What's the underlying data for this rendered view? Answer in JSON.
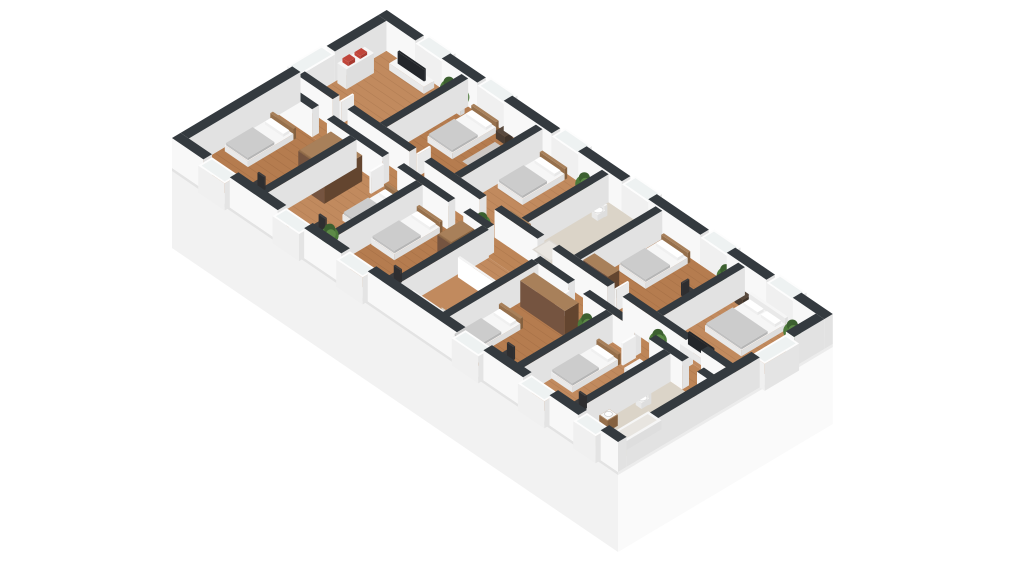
{
  "scene": {
    "description": "isometric-3d-floor-plan",
    "width": 1024,
    "height": 576,
    "background": "#ffffff"
  },
  "projection": {
    "ox": 172,
    "oy": 168,
    "ux": 0.826,
    "uy": 0.563,
    "vx": 0.859,
    "vy": -0.512,
    "planLength": 540,
    "planWidth": 250,
    "wallHeightExt": 30,
    "wallHeightInt": 28,
    "plinthDepth": 80
  },
  "colors": {
    "wallTop": "#343a3f",
    "wallTopDark": "#2b3035",
    "wallFace": "#f8f8f8",
    "wallFaceShade": "#e2e2e2",
    "plinthFront": "#f2f2f2",
    "plinthEnd": "#fafafa",
    "floorWoodA": "#b57c4f",
    "floorWoodB": "#c18a5e",
    "floorCorridor": "#bd8557",
    "floorBath": "#dbd4c8",
    "plankLine": "rgba(60,30,10,0.10)",
    "furnWhiteTop": "#f6f6f6",
    "furnWhiteF1": "#e9e9e9",
    "furnWhiteF2": "#dedede",
    "blanketTop": "#cccccc",
    "blanketF1": "#c0c0c0",
    "blanketF2": "#b5b5b5",
    "pillow": "#ffffff",
    "woodDarkTop": "#8a6747",
    "woodDarkF1": "#755440",
    "woodDarkF2": "#63452f",
    "woodMidTop": "#a8805a",
    "woodMidF1": "#96704c",
    "woodMidF2": "#85613f",
    "nightTop": "#58493d",
    "nightF1": "#4a3d33",
    "nightF2": "#3e332a",
    "chair": "#3c3c3e",
    "chairDark": "#2e2e30",
    "tv": "#23262a",
    "glass": "#eef2f2",
    "windowFrameTop": "#fdfdfd",
    "windowFrameF1": "#f0f0f0",
    "windowFrameF2": "#e4e4e4",
    "rug": "#d0d0d0",
    "plantGreen": "#4d7a3a",
    "plantGreenDark": "#3c6030",
    "plantGreenLight": "#5d8a47",
    "pot": "#ececec",
    "stairSide": "#d6d0c7",
    "rail": "#f4f4f4",
    "shelfAccent": "#c0453a",
    "showerTray": "#dcd8d2",
    "tubInner": "#e8e5e0"
  },
  "rooms": [
    {
      "id": "living-room",
      "x": 10,
      "y": 145,
      "w": 95,
      "h": 95,
      "floor": "floorWoodB",
      "wood": true
    },
    {
      "id": "bedroom-2",
      "x": 105,
      "y": 145,
      "w": 90,
      "h": 95,
      "floor": "floorWoodA",
      "wood": true
    },
    {
      "id": "bedroom-3",
      "x": 195,
      "y": 145,
      "w": 80,
      "h": 95,
      "floor": "floorWoodB",
      "wood": true
    },
    {
      "id": "bathroom-1",
      "x": 275,
      "y": 145,
      "w": 65,
      "h": 95,
      "floor": "floorBath",
      "wood": false
    },
    {
      "id": "bedroom-4",
      "x": 340,
      "y": 145,
      "w": 100,
      "h": 95,
      "floor": "floorWoodA",
      "wood": true
    },
    {
      "id": "bedroom-5",
      "x": 440,
      "y": 145,
      "w": 90,
      "h": 95,
      "floor": "floorWoodB",
      "wood": true
    },
    {
      "id": "bedroom-6",
      "x": 10,
      "y": 10,
      "w": 90,
      "h": 105,
      "floor": "floorWoodA",
      "wood": true
    },
    {
      "id": "bedroom-7",
      "x": 100,
      "y": 10,
      "w": 80,
      "h": 105,
      "floor": "floorWoodB",
      "wood": true
    },
    {
      "id": "bedroom-8",
      "x": 180,
      "y": 10,
      "w": 80,
      "h": 105,
      "floor": "floorWoodA",
      "wood": true
    },
    {
      "id": "stairwell",
      "x": 260,
      "y": 10,
      "w": 60,
      "h": 105,
      "floor": "floorWoodB",
      "wood": true
    },
    {
      "id": "bedroom-9",
      "x": 320,
      "y": 10,
      "w": 90,
      "h": 105,
      "floor": "floorWoodA",
      "wood": true
    },
    {
      "id": "bedroom-10",
      "x": 410,
      "y": 10,
      "w": 70,
      "h": 105,
      "floor": "floorWoodB",
      "wood": true
    },
    {
      "id": "bathroom-2",
      "x": 480,
      "y": 10,
      "w": 50,
      "h": 105,
      "floor": "floorBath",
      "wood": false
    },
    {
      "id": "corridor",
      "x": 10,
      "y": 115,
      "w": 520,
      "h": 30,
      "floor": "floorCorridor",
      "wood": true
    }
  ],
  "walls": {
    "exterior": [
      {
        "x": 0,
        "y": 240,
        "w": 45,
        "h": 10
      },
      {
        "x": 77,
        "y": 240,
        "w": 43,
        "h": 10
      },
      {
        "x": 152,
        "y": 240,
        "w": 58,
        "h": 10
      },
      {
        "x": 242,
        "y": 240,
        "w": 53,
        "h": 10
      },
      {
        "x": 327,
        "y": 240,
        "w": 63,
        "h": 10
      },
      {
        "x": 422,
        "y": 240,
        "w": 48,
        "h": 10
      },
      {
        "x": 502,
        "y": 240,
        "w": 38,
        "h": 10
      },
      {
        "x": 0,
        "y": 0,
        "w": 38,
        "h": 10
      },
      {
        "x": 70,
        "y": 0,
        "w": 58,
        "h": 10
      },
      {
        "x": 160,
        "y": 0,
        "w": 45,
        "h": 10
      },
      {
        "x": 237,
        "y": 0,
        "w": 108,
        "h": 10
      },
      {
        "x": 377,
        "y": 0,
        "w": 48,
        "h": 10
      },
      {
        "x": 457,
        "y": 0,
        "w": 35,
        "h": 10
      },
      {
        "x": 519,
        "y": 0,
        "w": 21,
        "h": 10
      },
      {
        "x": 0,
        "y": 10,
        "w": 10,
        "h": 130
      },
      {
        "x": 0,
        "y": 180,
        "w": 10,
        "h": 60
      },
      {
        "x": 530,
        "y": 10,
        "w": 10,
        "h": 155
      },
      {
        "x": 530,
        "y": 205,
        "w": 10,
        "h": 35
      }
    ],
    "interior": [
      {
        "x": 10,
        "y": 115,
        "w": 40,
        "h": 8
      },
      {
        "x": 68,
        "y": 115,
        "w": 67,
        "h": 8
      },
      {
        "x": 153,
        "y": 115,
        "w": 62,
        "h": 8
      },
      {
        "x": 233,
        "y": 115,
        "w": 29,
        "h": 8
      },
      {
        "x": 318,
        "y": 115,
        "w": 42,
        "h": 8
      },
      {
        "x": 378,
        "y": 115,
        "w": 62,
        "h": 8
      },
      {
        "x": 458,
        "y": 115,
        "w": 40,
        "h": 8
      },
      {
        "x": 516,
        "y": 115,
        "w": 14,
        "h": 8
      },
      {
        "x": 10,
        "y": 137,
        "w": 42,
        "h": 8
      },
      {
        "x": 70,
        "y": 137,
        "w": 75,
        "h": 8
      },
      {
        "x": 163,
        "y": 137,
        "w": 67,
        "h": 8
      },
      {
        "x": 248,
        "y": 137,
        "w": 52,
        "h": 8
      },
      {
        "x": 318,
        "y": 137,
        "w": 67,
        "h": 8
      },
      {
        "x": 403,
        "y": 137,
        "w": 77,
        "h": 8
      },
      {
        "x": 498,
        "y": 137,
        "w": 32,
        "h": 8
      },
      {
        "x": 101,
        "y": 145,
        "w": 8,
        "h": 95
      },
      {
        "x": 191,
        "y": 145,
        "w": 8,
        "h": 95
      },
      {
        "x": 271,
        "y": 145,
        "w": 8,
        "h": 95
      },
      {
        "x": 336,
        "y": 145,
        "w": 8,
        "h": 95
      },
      {
        "x": 436,
        "y": 145,
        "w": 8,
        "h": 95
      },
      {
        "x": 96,
        "y": 10,
        "w": 8,
        "h": 105
      },
      {
        "x": 176,
        "y": 10,
        "w": 8,
        "h": 105
      },
      {
        "x": 256,
        "y": 10,
        "w": 8,
        "h": 105
      },
      {
        "x": 316,
        "y": 10,
        "w": 8,
        "h": 105
      },
      {
        "x": 406,
        "y": 10,
        "w": 8,
        "h": 105
      },
      {
        "x": 476,
        "y": 10,
        "w": 8,
        "h": 105
      }
    ]
  },
  "windows": [
    {
      "x": 45,
      "y": 240,
      "w": 32,
      "h": 16
    },
    {
      "x": 120,
      "y": 240,
      "w": 32,
      "h": 16
    },
    {
      "x": 210,
      "y": 240,
      "w": 32,
      "h": 16
    },
    {
      "x": 295,
      "y": 240,
      "w": 32,
      "h": 16
    },
    {
      "x": 390,
      "y": 240,
      "w": 32,
      "h": 16
    },
    {
      "x": 470,
      "y": 240,
      "w": 32,
      "h": 16
    },
    {
      "x": 38,
      "y": -6,
      "w": 32,
      "h": 16
    },
    {
      "x": 128,
      "y": -6,
      "w": 32,
      "h": 16
    },
    {
      "x": 205,
      "y": -6,
      "w": 32,
      "h": 16
    },
    {
      "x": 345,
      "y": -6,
      "w": 32,
      "h": 16
    },
    {
      "x": 425,
      "y": -6,
      "w": 32,
      "h": 16
    },
    {
      "x": 492,
      "y": -6,
      "w": 27,
      "h": 16
    },
    {
      "x": -6,
      "y": 140,
      "w": 16,
      "h": 40
    },
    {
      "x": 530,
      "y": 165,
      "w": 16,
      "h": 40
    }
  ],
  "furniture": [
    {
      "t": "tvstand",
      "room": "living-room",
      "x": 30,
      "y": 224,
      "w": 42,
      "h": 12
    },
    {
      "t": "shelf",
      "room": "living-room",
      "x": 13,
      "y": 180,
      "w": 11,
      "h": 32
    },
    {
      "t": "bench",
      "room": "living-room",
      "x": 58,
      "y": 149,
      "w": 32,
      "h": 11
    },
    {
      "t": "plant",
      "room": "living-room",
      "x": 96,
      "y": 230
    },
    {
      "t": "bed",
      "room": "bedroom-2",
      "x": 120,
      "y": 182,
      "w": 30,
      "h": 54,
      "head": "N"
    },
    {
      "t": "rug",
      "room": "bedroom-2",
      "x": 158,
      "y": 186,
      "w": 28,
      "h": 38
    },
    {
      "t": "nightstand",
      "room": "bedroom-2",
      "x": 155,
      "y": 228,
      "w": 11,
      "h": 9
    },
    {
      "t": "plant",
      "room": "bedroom-2",
      "x": 111,
      "y": 229
    },
    {
      "t": "bed",
      "room": "bedroom-3",
      "x": 203,
      "y": 184,
      "w": 30,
      "h": 52,
      "head": "N"
    },
    {
      "t": "dresser",
      "room": "bedroom-3",
      "x": 243,
      "y": 149,
      "w": 24,
      "h": 12
    },
    {
      "t": "plant",
      "room": "bedroom-3",
      "x": 263,
      "y": 227
    },
    {
      "t": "toilet",
      "room": "bathroom-1",
      "x": 283,
      "y": 216
    },
    {
      "t": "sink",
      "room": "bathroom-1",
      "x": 320,
      "y": 222
    },
    {
      "t": "shower",
      "room": "bathroom-1",
      "x": 281,
      "y": 149,
      "w": 22,
      "h": 20
    },
    {
      "t": "bed",
      "room": "bedroom-4",
      "x": 350,
      "y": 184,
      "w": 32,
      "h": 52,
      "head": "N"
    },
    {
      "t": "desk",
      "room": "bedroom-4",
      "x": 421,
      "y": 188,
      "w": 13,
      "h": 32,
      "chair": "W"
    },
    {
      "t": "wardrobe",
      "room": "bedroom-4",
      "x": 344,
      "y": 148,
      "w": 30,
      "h": 13
    },
    {
      "t": "plant",
      "room": "bedroom-4",
      "x": 430,
      "y": 231
    },
    {
      "t": "bedDouble",
      "room": "bedroom-5",
      "x": 456,
      "y": 182,
      "w": 44,
      "h": 54,
      "head": "N"
    },
    {
      "t": "nightstand",
      "room": "bedroom-5",
      "x": 445,
      "y": 227,
      "w": 10,
      "h": 9
    },
    {
      "t": "nightstand",
      "room": "bedroom-5",
      "x": 505,
      "y": 227,
      "w": 10,
      "h": 9
    },
    {
      "t": "tvstand",
      "room": "bedroom-5",
      "x": 460,
      "y": 149,
      "w": 40,
      "h": 11
    },
    {
      "t": "plant",
      "room": "bedroom-5",
      "x": 520,
      "y": 222
    },
    {
      "t": "bed",
      "room": "bedroom-6",
      "x": 14,
      "y": 48,
      "w": 28,
      "h": 56,
      "head": "N"
    },
    {
      "t": "desk",
      "room": "bedroom-6",
      "x": 54,
      "y": 13,
      "w": 30,
      "h": 13,
      "chair": "N"
    },
    {
      "t": "bookcase",
      "room": "bedroom-6",
      "x": 78,
      "y": 72,
      "w": 17,
      "h": 38
    },
    {
      "t": "wardrobe",
      "room": "bedroom-7",
      "x": 103,
      "y": 62,
      "w": 17,
      "h": 44
    },
    {
      "t": "desk",
      "room": "bedroom-7",
      "x": 128,
      "y": 13,
      "w": 30,
      "h": 13,
      "chair": "N"
    },
    {
      "t": "bed",
      "room": "bedroom-7",
      "x": 146,
      "y": 58,
      "w": 29,
      "h": 52,
      "head": "N"
    },
    {
      "t": "plant",
      "room": "bedroom-7",
      "x": 168,
      "y": 22
    },
    {
      "t": "bed",
      "room": "bedroom-8",
      "x": 185,
      "y": 54,
      "w": 28,
      "h": 56,
      "head": "N"
    },
    {
      "t": "desk",
      "room": "bedroom-8",
      "x": 220,
      "y": 13,
      "w": 28,
      "h": 13,
      "chair": "N"
    },
    {
      "t": "bookcase",
      "room": "bedroom-8",
      "x": 236,
      "y": 82,
      "w": 17,
      "h": 28
    },
    {
      "t": "stairs",
      "room": "stairwell",
      "x": 265,
      "y": 26,
      "w": 48,
      "h": 52
    },
    {
      "t": "wardrobe",
      "room": "bedroom-9",
      "x": 328,
      "y": 90,
      "w": 54,
      "h": 16
    },
    {
      "t": "bed",
      "room": "bedroom-9",
      "x": 324,
      "y": 16,
      "w": 26,
      "h": 56,
      "head": "N"
    },
    {
      "t": "desk",
      "room": "bedroom-9",
      "x": 356,
      "y": 13,
      "w": 30,
      "h": 13,
      "chair": "N"
    },
    {
      "t": "plant",
      "room": "bedroom-9",
      "x": 398,
      "y": 100
    },
    {
      "t": "bed",
      "room": "bedroom-10",
      "x": 413,
      "y": 44,
      "w": 26,
      "h": 56,
      "head": "N"
    },
    {
      "t": "desk",
      "room": "bedroom-10",
      "x": 444,
      "y": 13,
      "w": 28,
      "h": 13,
      "chair": "N"
    },
    {
      "t": "cabinet",
      "room": "bedroom-10",
      "x": 458,
      "y": 86,
      "w": 14,
      "h": 18
    },
    {
      "t": "toilet",
      "room": "bathroom-2",
      "x": 486,
      "y": 72
    },
    {
      "t": "sink",
      "room": "bathroom-2",
      "x": 486,
      "y": 30
    },
    {
      "t": "tub",
      "room": "bathroom-2",
      "x": 508,
      "y": 14,
      "w": 16,
      "h": 52
    },
    {
      "t": "plant",
      "room": "corridor",
      "x": 243,
      "y": 127
    },
    {
      "t": "plant",
      "room": "corridor",
      "x": 453,
      "y": 130
    },
    {
      "t": "door",
      "room": "corridor",
      "x": 52,
      "y": 145,
      "w": 2,
      "h": 15
    },
    {
      "t": "door",
      "room": "corridor",
      "x": 145,
      "y": 145,
      "w": 2,
      "h": 15
    },
    {
      "t": "door",
      "room": "corridor",
      "x": 385,
      "y": 145,
      "w": 2,
      "h": 15
    },
    {
      "t": "door",
      "room": "corridor",
      "x": 135,
      "y": 100,
      "w": 2,
      "h": 15
    },
    {
      "t": "door",
      "room": "corridor",
      "x": 360,
      "y": 100,
      "w": 2,
      "h": 15
    },
    {
      "t": "door",
      "room": "corridor",
      "x": 440,
      "y": 100,
      "w": 2,
      "h": 15
    }
  ]
}
